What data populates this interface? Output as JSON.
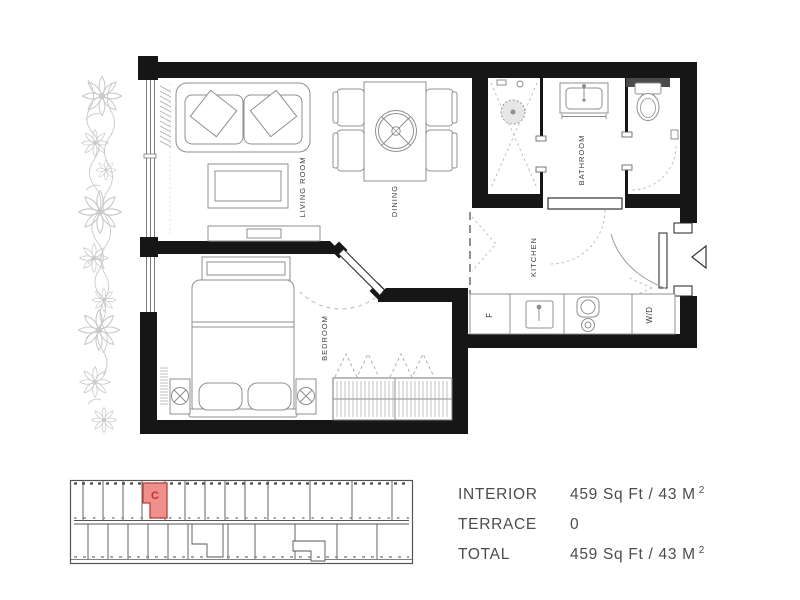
{
  "floor_plan": {
    "rooms": {
      "living_room": "LIVING ROOM",
      "dining": "DINING",
      "bedroom": "BEDROOM",
      "kitchen": "KITCHEN",
      "bathroom": "BATHROOM"
    },
    "appliances": {
      "fridge": "F",
      "washer_dryer": "W/D"
    }
  },
  "key_plan": {
    "unit_label": "C",
    "highlight_fill": "#f0908c",
    "highlight_stroke": "#b2423a",
    "letter_color": "#c2342c"
  },
  "stats": {
    "rows": [
      {
        "label": "INTERIOR",
        "value": "459 Sq Ft / 43 M",
        "sup": "2"
      },
      {
        "label": "TERRACE",
        "value": "0",
        "sup": ""
      },
      {
        "label": "TOTAL",
        "value": "459 Sq Ft / 43 M",
        "sup": "2"
      }
    ]
  },
  "icons": {
    "entry_arrow": "left-pointing-triangle",
    "lamp": "circle-with-x",
    "shower_drain": "dotted-circle",
    "stove": "two-burner-cooktop"
  }
}
